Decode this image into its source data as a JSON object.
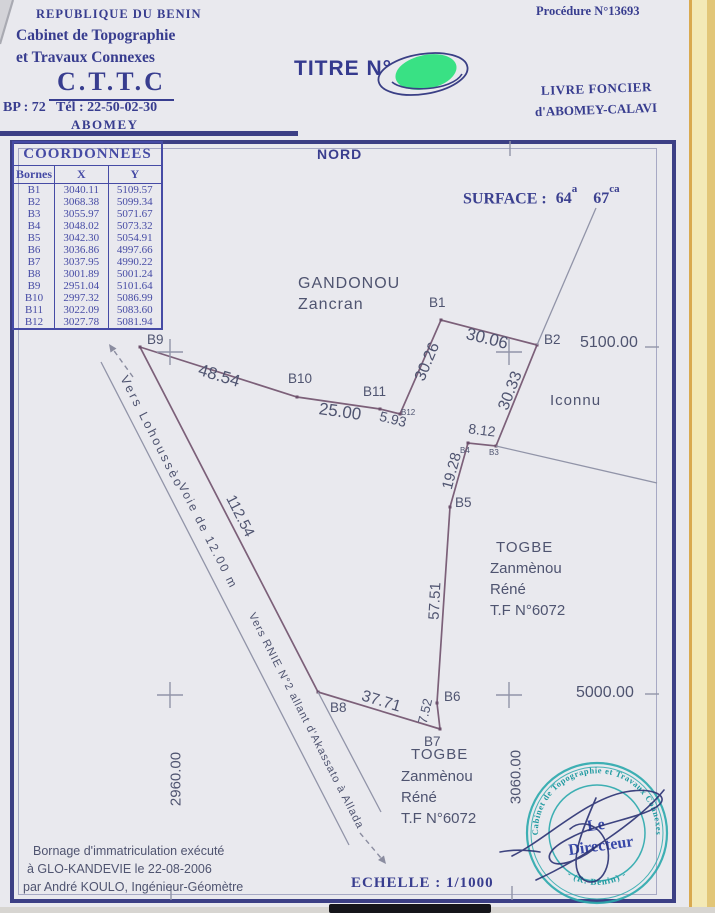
{
  "header": {
    "country": "REPUBLIQUE DU BENIN",
    "office_line1": "Cabinet de Topographie",
    "office_line2": "et Travaux Connexes",
    "acronym": "C.T.T.C",
    "contact": "BP : 72   Tél : 22-50-02-30",
    "city": "ABOMEY",
    "title_label": "TITRE N°",
    "procedure": "Procédure N°13693",
    "registry_line1": "LIVRE FONCIER",
    "registry_line2": "d'ABOMEY-CALAVI"
  },
  "table": {
    "title": "COORDONNEES",
    "col_bornes": "Bornes",
    "col_x": "X",
    "col_y": "Y",
    "rows": [
      [
        "B1",
        "3040.11",
        "5109.57"
      ],
      [
        "B2",
        "3068.38",
        "5099.34"
      ],
      [
        "B3",
        "3055.97",
        "5071.67"
      ],
      [
        "B4",
        "3048.02",
        "5073.32"
      ],
      [
        "B5",
        "3042.30",
        "5054.91"
      ],
      [
        "B6",
        "3036.86",
        "4997.66"
      ],
      [
        "B7",
        "3037.95",
        "4990.22"
      ],
      [
        "B8",
        "3001.89",
        "5001.24"
      ],
      [
        "B9",
        "2951.04",
        "5101.64"
      ],
      [
        "B10",
        "2997.32",
        "5086.99"
      ],
      [
        "B11",
        "3022.09",
        "5083.60"
      ],
      [
        "B12",
        "3027.78",
        "5081.94"
      ]
    ]
  },
  "map": {
    "north": "NORD",
    "surface": {
      "label": "SURFACE :",
      "a_value": "64",
      "a_unit": "a",
      "ca_value": "67",
      "ca_unit": "ca"
    },
    "grid_labels": {
      "n5100": "5100.00",
      "n5000": "5000.00",
      "e2960": "2960.00",
      "e3060": "3060.00"
    },
    "points": {
      "b1": "B1",
      "b2": "B2",
      "b3": "B3",
      "b4": "B4",
      "b5": "B5",
      "b6": "B6",
      "b7": "B7",
      "b8": "B8",
      "b9": "B9",
      "b10": "B10",
      "b11": "B11",
      "b12": "B12"
    },
    "distances": {
      "b1_b2": "30.06",
      "b2_b3": "30.33",
      "b3_b4": "8.12",
      "b4_b5": "19.28",
      "b5_b6": "57.51",
      "b6_b7": "7.52",
      "b7_b8": "37.71",
      "b8_b9": "112.54",
      "b9_b10": "48.54",
      "b10_b11": "25.00",
      "b11_b12": "5.93",
      "b12_b1": "30.26"
    },
    "owners": {
      "north_name": "GANDONOU",
      "north_firstname": "Zancran",
      "east_unknown": "Iconnu",
      "south_name": "TOGBE",
      "south_firstname1": "Zanmènou",
      "south_firstname2": "Réné",
      "south_title": "T.F N°6072"
    },
    "roads": {
      "to_lohousseo": "Vers Lohoussèo",
      "width_label": "Voie de 12.00 m",
      "to_rnie": "Vers RNIE N°2 allant d'Akassato à Allada"
    }
  },
  "footer": {
    "note_line1": "Bornage d'immatriculation exécuté",
    "note_line2": "à GLO-KANDEVIE le 22-08-2006",
    "note_line3": "par André KOULO, Ingénieur-Géomètre",
    "scale": "ECHELLE : 1/1000"
  },
  "stamp": {
    "ring_top": "Cabinet de Topographie et Travaux Connexes",
    "ring_bottom": "- (R. Bénin) -",
    "center_line1": "Le",
    "center_line2": "Directeur"
  },
  "colors": {
    "ink": "#383d8f",
    "annotation": "#4f5470",
    "boundary_line": "#7c6079",
    "grid_line": "#9194a8",
    "stamp_teal": "#2aa8ac",
    "marker_green": "#2fe07d",
    "paper": "#e9e9ee",
    "side_paper": "#f3e9b6"
  }
}
